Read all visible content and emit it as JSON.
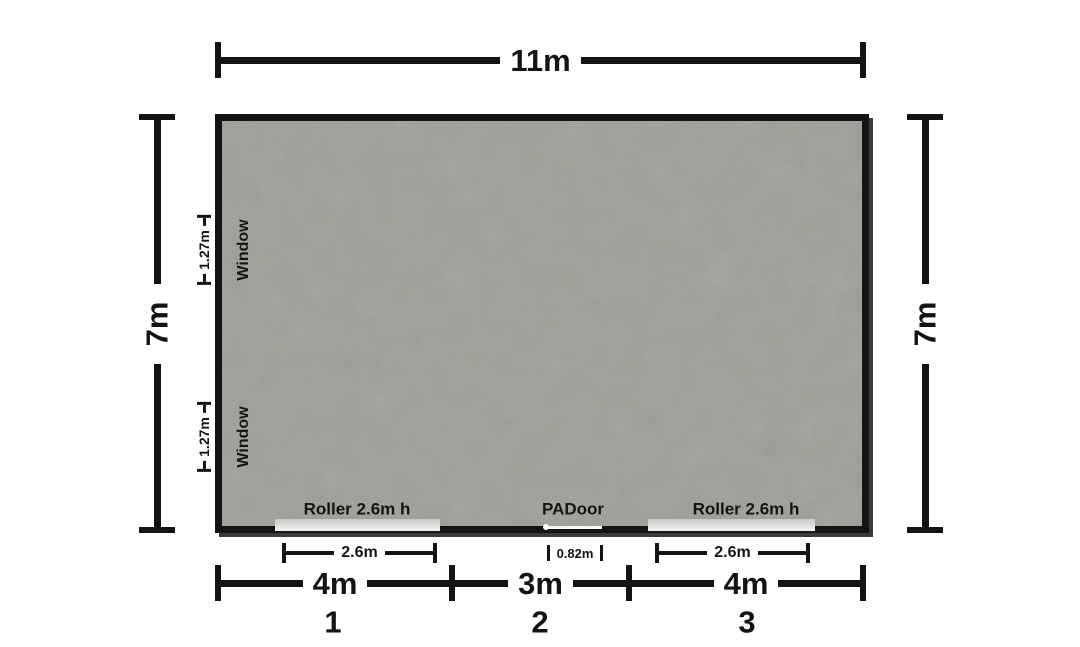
{
  "floorplan": {
    "overall": {
      "width_label": "11m",
      "height_label_left": "7m",
      "height_label_right": "7m"
    },
    "windows": [
      {
        "name": "Window",
        "offset": "1.27m"
      },
      {
        "name": "Window",
        "offset": "1.27m"
      }
    ],
    "doors": {
      "roller_left": {
        "label": "Roller 2.6m h",
        "width": "2.6m"
      },
      "pa_door": {
        "label": "PADoor",
        "width": "0.82m"
      },
      "roller_right": {
        "label": "Roller 2.6m h",
        "width": "2.6m"
      }
    },
    "bays": [
      {
        "width": "4m",
        "number": "1"
      },
      {
        "width": "3m",
        "number": "2"
      },
      {
        "width": "4m",
        "number": "3"
      }
    ],
    "colors": {
      "wall": "#141414",
      "floor_concrete": "#9c9c94",
      "roller_door": "#e0e0de",
      "pa_door": "#f5f5f2",
      "dimension_ink": "#141414",
      "background": "#ffffff"
    }
  }
}
